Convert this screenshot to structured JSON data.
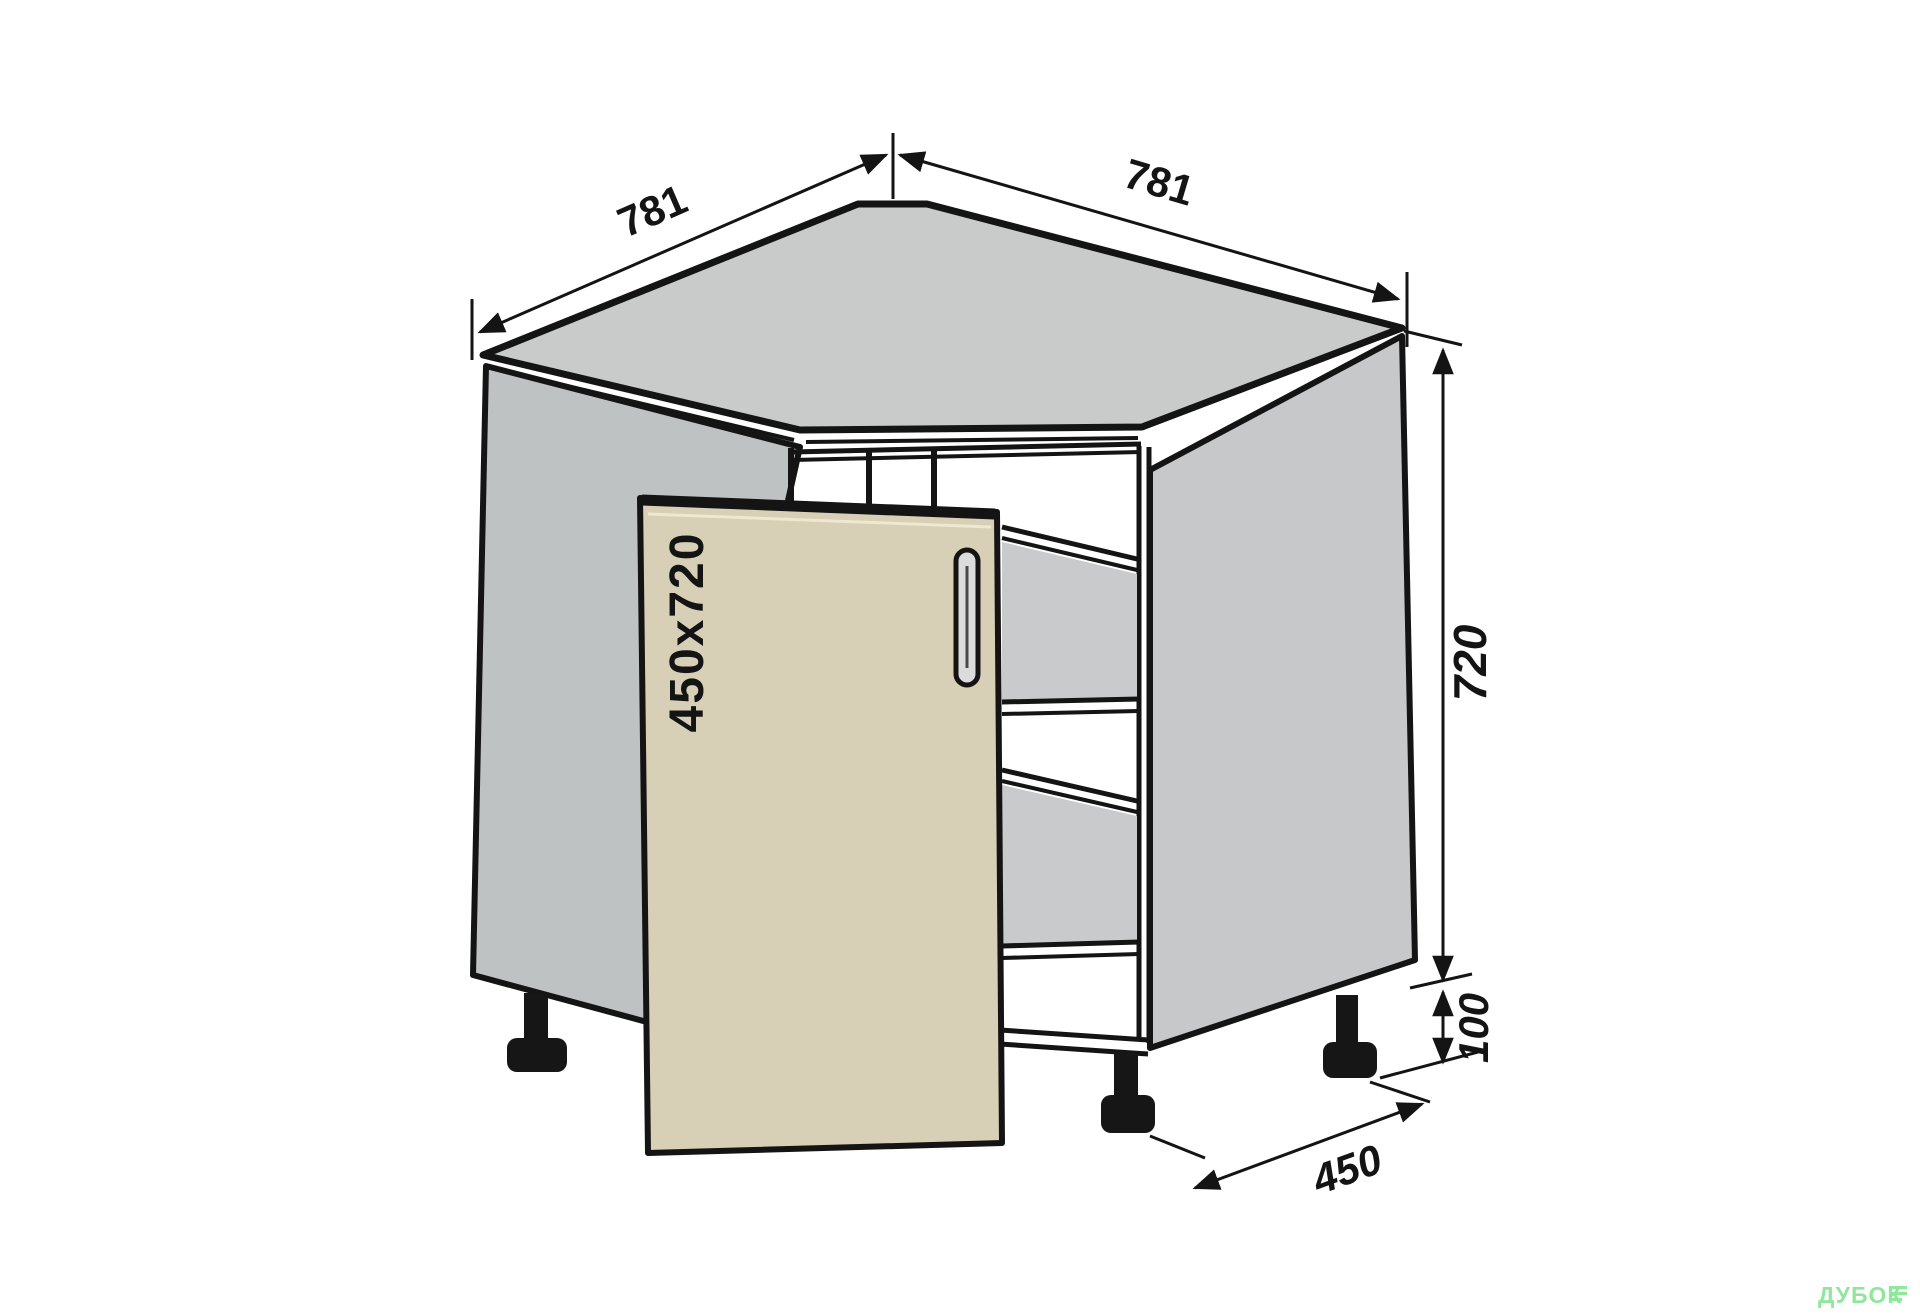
{
  "dimensions": {
    "top_width_left": "781",
    "top_width_right": "781",
    "body_height": "720",
    "leg_height": "100",
    "side_depth": "450",
    "door_facade_size": "450x720"
  },
  "watermark": {
    "brand": "ДУБОК"
  },
  "colors": {
    "line": "#141414",
    "top_surface": "#c9cbcb",
    "side_panel_left": "#bfc2c3",
    "side_panel_right": "#c6c8c9",
    "interior_shadow": "#c8cacb",
    "door": "#d7d0b6",
    "door_edge_highlight": "#efe8d0",
    "handle_fill": "#dcdcdc",
    "leg": "#161616",
    "watermark": "#8fe79c",
    "background": "#ffffff"
  }
}
